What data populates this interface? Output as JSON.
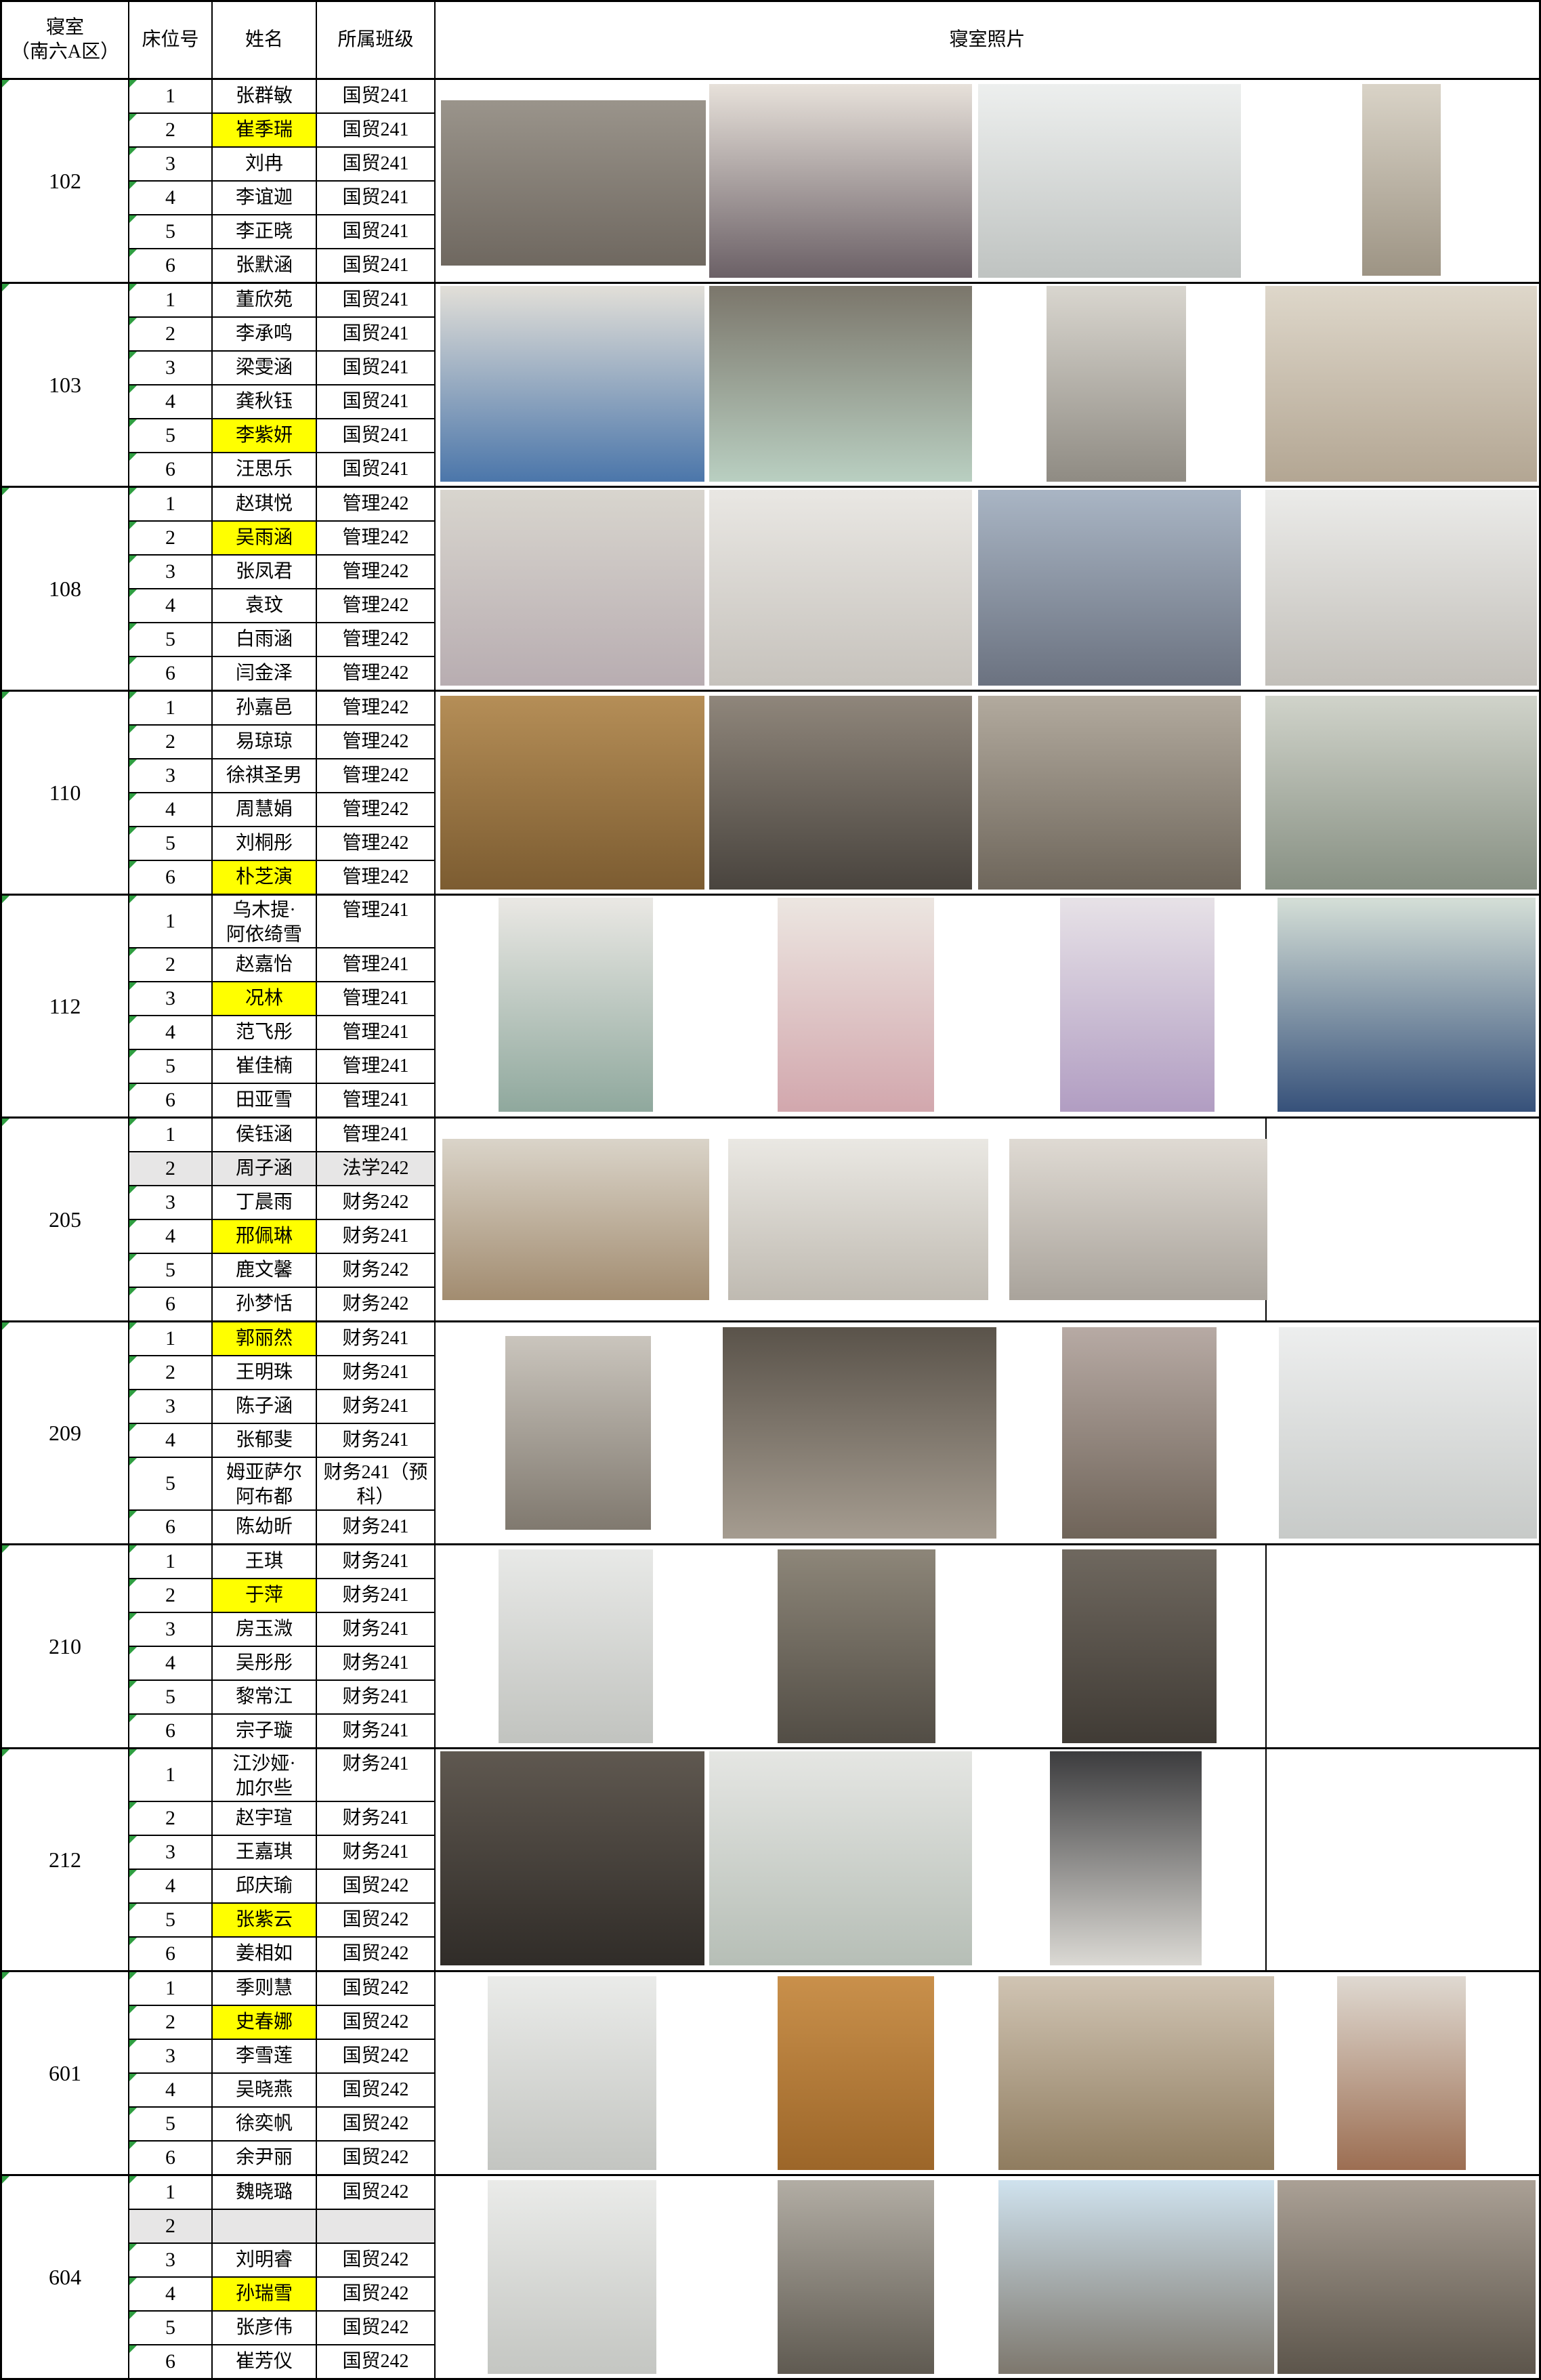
{
  "header": {
    "room": "寝室\n（南六A区）",
    "bed": "床位号",
    "name": "姓名",
    "cls": "所属班级",
    "photos": "寝室照片"
  },
  "colors": {
    "highlight_yellow": "#ffff00",
    "vacant_gray": "#e7e6e6",
    "triangle_green": "#2f9e41",
    "border_black": "#000000"
  },
  "rooms": [
    {
      "id": "102",
      "beds": [
        {
          "no": "1",
          "name": "张群敏",
          "cls": "国贸241"
        },
        {
          "no": "2",
          "name": "崔季瑞",
          "cls": "国贸241",
          "hl": true
        },
        {
          "no": "3",
          "name": "刘冉",
          "cls": "国贸241"
        },
        {
          "no": "4",
          "name": "李谊迦",
          "cls": "国贸241"
        },
        {
          "no": "5",
          "name": "李正晓",
          "cls": "国贸241"
        },
        {
          "no": "6",
          "name": "张默涵",
          "cls": "国贸241"
        }
      ],
      "photos": [
        {
          "desc": "bunk-room-doorway",
          "x": 0.5,
          "w": 24,
          "y": 10,
          "h": 82,
          "c": [
            "#9a948b",
            "#6f6860"
          ]
        },
        {
          "desc": "hanging-clothes",
          "x": 24.8,
          "w": 23.8,
          "y": 2,
          "h": 96,
          "c": [
            "#e7e1da",
            "#6b6066"
          ]
        },
        {
          "desc": "washroom-pipes-sink",
          "x": 49.2,
          "w": 23.8,
          "y": 2,
          "h": 96,
          "c": [
            "#edefee",
            "#bfc3c1"
          ]
        },
        {
          "desc": "tall-storage-cabinet",
          "x": 84,
          "w": 7.1,
          "y": 2,
          "h": 95,
          "c": [
            "#d9d3c7",
            "#9d9484"
          ]
        }
      ]
    },
    {
      "id": "103",
      "beds": [
        {
          "no": "1",
          "name": "董欣苑",
          "cls": "国贸241"
        },
        {
          "no": "2",
          "name": "李承鸣",
          "cls": "国贸241"
        },
        {
          "no": "3",
          "name": "梁雯涵",
          "cls": "国贸241"
        },
        {
          "no": "4",
          "name": "龚秋钰",
          "cls": "国贸241"
        },
        {
          "no": "5",
          "name": "李紫妍",
          "cls": "国贸241",
          "hl": true
        },
        {
          "no": "6",
          "name": "汪思乐",
          "cls": "国贸241"
        }
      ],
      "photos": [
        {
          "desc": "bed-blue-plaid",
          "x": 0.4,
          "w": 24,
          "y": 1,
          "h": 97,
          "c": [
            "#e2dfd8",
            "#4b76aa"
          ]
        },
        {
          "desc": "desk-bookshelf",
          "x": 24.8,
          "w": 23.8,
          "y": 1,
          "h": 97,
          "c": [
            "#7b766b",
            "#b9cfc1"
          ]
        },
        {
          "desc": "corridor-bunks",
          "x": 55.4,
          "w": 12.6,
          "y": 1,
          "h": 97,
          "c": [
            "#d9d6cf",
            "#8f8b83"
          ]
        },
        {
          "desc": "bathroom-squat-toilet",
          "x": 75.2,
          "w": 24.6,
          "y": 1,
          "h": 97,
          "c": [
            "#ded7ca",
            "#b3a693"
          ]
        }
      ]
    },
    {
      "id": "108",
      "beds": [
        {
          "no": "1",
          "name": "赵琪悦",
          "cls": "管理242"
        },
        {
          "no": "2",
          "name": "吴雨涵",
          "cls": "管理242",
          "hl": true
        },
        {
          "no": "3",
          "name": "张凤君",
          "cls": "管理242"
        },
        {
          "no": "4",
          "name": "袁玟",
          "cls": "管理242"
        },
        {
          "no": "5",
          "name": "白雨涵",
          "cls": "管理242"
        },
        {
          "no": "6",
          "name": "闫金泽",
          "cls": "管理242"
        }
      ],
      "photos": [
        {
          "desc": "balcony-window-room",
          "x": 0.4,
          "w": 24,
          "y": 1,
          "h": 97,
          "c": [
            "#d8d5ce",
            "#b8adb1"
          ]
        },
        {
          "desc": "white-lockers",
          "x": 24.8,
          "w": 23.8,
          "y": 1,
          "h": 97,
          "c": [
            "#e9e7e3",
            "#c6c2bc"
          ]
        },
        {
          "desc": "corridor-blue-curtains",
          "x": 49.2,
          "w": 23.8,
          "y": 1,
          "h": 97,
          "c": [
            "#a9b5c4",
            "#6b7280"
          ]
        },
        {
          "desc": "washroom-double-sink",
          "x": 75.2,
          "w": 24.6,
          "y": 1,
          "h": 97,
          "c": [
            "#ebebe9",
            "#c2bfb9"
          ]
        }
      ]
    },
    {
      "id": "110",
      "beds": [
        {
          "no": "1",
          "name": "孙嘉邑",
          "cls": "管理242"
        },
        {
          "no": "2",
          "name": "易琼琼",
          "cls": "管理242"
        },
        {
          "no": "3",
          "name": "徐祺圣男",
          "cls": "管理242"
        },
        {
          "no": "4",
          "name": "周慧娟",
          "cls": "管理242"
        },
        {
          "no": "5",
          "name": "刘桐彤",
          "cls": "管理242"
        },
        {
          "no": "6",
          "name": "朴芝演",
          "cls": "管理242",
          "hl": true
        }
      ],
      "photos": [
        {
          "desc": "poster-drawing-on-desk",
          "x": 0.4,
          "w": 24,
          "y": 2,
          "h": 96,
          "c": [
            "#b58e57",
            "#7c5c31"
          ]
        },
        {
          "desc": "dark-room-corner",
          "x": 24.8,
          "w": 23.8,
          "y": 2,
          "h": 96,
          "c": [
            "#8f867b",
            "#49443e"
          ]
        },
        {
          "desc": "bunks-near-window",
          "x": 49.2,
          "w": 23.8,
          "y": 2,
          "h": 96,
          "c": [
            "#b2aa9e",
            "#6e665b"
          ]
        },
        {
          "desc": "bunks-white-curtain",
          "x": 75.2,
          "w": 24.6,
          "y": 2,
          "h": 96,
          "c": [
            "#d0d3ca",
            "#879083"
          ]
        }
      ]
    },
    {
      "id": "112",
      "beds": [
        {
          "no": "1",
          "name": "乌木提·\n阿依绮雪",
          "cls": "管理241",
          "tall": true
        },
        {
          "no": "2",
          "name": "赵嘉怡",
          "cls": "管理241"
        },
        {
          "no": "3",
          "name": "况林",
          "cls": "管理241",
          "hl": true
        },
        {
          "no": "4",
          "name": "范飞彤",
          "cls": "管理241"
        },
        {
          "no": "5",
          "name": "崔佳楠",
          "cls": "管理241"
        },
        {
          "no": "6",
          "name": "田亚雪",
          "cls": "管理241"
        }
      ],
      "photos": [
        {
          "desc": "shoe-rack",
          "x": 5.7,
          "w": 14,
          "y": 1,
          "h": 97,
          "c": [
            "#eae8e4",
            "#8fa89d"
          ]
        },
        {
          "desc": "pink-bunk-shelves",
          "x": 31,
          "w": 14.2,
          "y": 1,
          "h": 97,
          "c": [
            "#ece6e1",
            "#d2a7ad"
          ]
        },
        {
          "desc": "purple-bunk-shelves",
          "x": 56.6,
          "w": 14,
          "y": 1,
          "h": 97,
          "c": [
            "#e7e2e7",
            "#b19dc2"
          ]
        },
        {
          "desc": "blue-curtained-bunks",
          "x": 76.3,
          "w": 23.4,
          "y": 1,
          "h": 97,
          "c": [
            "#d5dfd7",
            "#36517a"
          ]
        }
      ]
    },
    {
      "id": "205",
      "divider": true,
      "beds": [
        {
          "no": "1",
          "name": "侯钰涵",
          "cls": "管理241"
        },
        {
          "no": "2",
          "name": "周子涵",
          "cls": "法学242",
          "gray": true
        },
        {
          "no": "3",
          "name": "丁晨雨",
          "cls": "财务242"
        },
        {
          "no": "4",
          "name": "邢佩琳",
          "cls": "财务241",
          "hl": true
        },
        {
          "no": "5",
          "name": "鹿文馨",
          "cls": "财务242"
        },
        {
          "no": "6",
          "name": "孙梦恬",
          "cls": "财务242"
        }
      ],
      "photos": [
        {
          "desc": "bunk-room-wood-floor",
          "x": 0.6,
          "w": 24.2,
          "y": 10,
          "h": 80,
          "c": [
            "#dad4c9",
            "#a28c70"
          ]
        },
        {
          "desc": "white-bunk-beds",
          "x": 26.5,
          "w": 23.6,
          "y": 10,
          "h": 80,
          "c": [
            "#eae8e3",
            "#bfbab1"
          ]
        },
        {
          "desc": "desks-shelf-ladder",
          "x": 52,
          "w": 23.4,
          "y": 10,
          "h": 80,
          "c": [
            "#dfdad3",
            "#a9a39b"
          ]
        }
      ]
    },
    {
      "id": "209",
      "beds": [
        {
          "no": "1",
          "name": "郭丽然",
          "cls": "财务241",
          "hl": true
        },
        {
          "no": "2",
          "name": "王明珠",
          "cls": "财务241"
        },
        {
          "no": "3",
          "name": "陈子涵",
          "cls": "财务241"
        },
        {
          "no": "4",
          "name": "张郁斐",
          "cls": "财务241"
        },
        {
          "no": "5",
          "name": "姆亚萨尔\n阿布都",
          "cls": "财务241（预\n科）",
          "tall": true
        },
        {
          "no": "6",
          "name": "陈幼昕",
          "cls": "财务241"
        }
      ],
      "photos": [
        {
          "desc": "door-lockers-corridor",
          "x": 6.3,
          "w": 13.2,
          "y": 6,
          "h": 88,
          "c": [
            "#cac5bd",
            "#80796f"
          ]
        },
        {
          "desc": "dark-bunks-window",
          "x": 26,
          "w": 24.8,
          "y": 2,
          "h": 96,
          "c": [
            "#5a534a",
            "#a59c90"
          ]
        },
        {
          "desc": "corridor-pink-desks",
          "x": 56.8,
          "w": 14,
          "y": 2,
          "h": 96,
          "c": [
            "#b7aaa4",
            "#6f6459"
          ]
        },
        {
          "desc": "washroom-mirror-sink",
          "x": 76.4,
          "w": 23.4,
          "y": 2,
          "h": 96,
          "c": [
            "#edeeee",
            "#c7cac8"
          ]
        }
      ]
    },
    {
      "id": "210",
      "divider": true,
      "beds": [
        {
          "no": "1",
          "name": "王琪",
          "cls": "财务241"
        },
        {
          "no": "2",
          "name": "于萍",
          "cls": "财务241",
          "hl": true
        },
        {
          "no": "3",
          "name": "房玉溦",
          "cls": "财务241"
        },
        {
          "no": "4",
          "name": "吴彤彤",
          "cls": "财务241"
        },
        {
          "no": "5",
          "name": "黎常江",
          "cls": "财务241"
        },
        {
          "no": "6",
          "name": "宗子璇",
          "cls": "财务241"
        }
      ],
      "photos": [
        {
          "desc": "squat-toilet-room",
          "x": 5.7,
          "w": 14,
          "y": 2,
          "h": 96,
          "c": [
            "#e8e9e7",
            "#c1c3bf"
          ]
        },
        {
          "desc": "corridor-between-lockers",
          "x": 31,
          "w": 14.3,
          "y": 2,
          "h": 96,
          "c": [
            "#8d8679",
            "#524d45"
          ]
        },
        {
          "desc": "dark-corridor-bunks",
          "x": 56.8,
          "w": 14,
          "y": 2,
          "h": 96,
          "c": [
            "#6f685f",
            "#403b35"
          ]
        }
      ]
    },
    {
      "id": "212",
      "divider": true,
      "beds": [
        {
          "no": "1",
          "name": "江沙娅·\n加尔些",
          "cls": "财务241",
          "tall": true
        },
        {
          "no": "2",
          "name": "赵宇瑄",
          "cls": "财务241"
        },
        {
          "no": "3",
          "name": "王嘉琪",
          "cls": "财务241"
        },
        {
          "no": "4",
          "name": "邱庆瑜",
          "cls": "国贸242"
        },
        {
          "no": "5",
          "name": "张紫云",
          "cls": "国贸242",
          "hl": true
        },
        {
          "no": "6",
          "name": "姜相如",
          "cls": "国贸242"
        }
      ],
      "photos": [
        {
          "desc": "dark-bunk-room-door-light",
          "x": 0.4,
          "w": 24,
          "y": 1,
          "h": 97,
          "c": [
            "#5f5850",
            "#302c28"
          ]
        },
        {
          "desc": "washroom-green-basin",
          "x": 24.8,
          "w": 23.8,
          "y": 1,
          "h": 97,
          "c": [
            "#e5e6e3",
            "#b6beb6"
          ]
        },
        {
          "desc": "white-corridor-clothes-top",
          "x": 55.7,
          "w": 13.7,
          "y": 1,
          "h": 97,
          "c": [
            "#3c3c3e",
            "#dbd9d4"
          ]
        }
      ]
    },
    {
      "id": "601",
      "beds": [
        {
          "no": "1",
          "name": "季则慧",
          "cls": "国贸242"
        },
        {
          "no": "2",
          "name": "史春娜",
          "cls": "国贸242",
          "hl": true
        },
        {
          "no": "3",
          "name": "李雪莲",
          "cls": "国贸242"
        },
        {
          "no": "4",
          "name": "吴晓燕",
          "cls": "国贸242"
        },
        {
          "no": "5",
          "name": "徐奕帆",
          "cls": "国贸242"
        },
        {
          "no": "6",
          "name": "余尹丽",
          "cls": "国贸242"
        }
      ],
      "photos": [
        {
          "desc": "bathroom-tall",
          "x": 4.7,
          "w": 15.3,
          "y": 2,
          "h": 96,
          "c": [
            "#eaebe9",
            "#c3c5c1"
          ]
        },
        {
          "desc": "wooden-door-red-sign",
          "x": 31,
          "w": 14.2,
          "y": 2,
          "h": 96,
          "c": [
            "#c9904b",
            "#9c6629"
          ]
        },
        {
          "desc": "desks-bookshelves-ladder",
          "x": 51,
          "w": 25,
          "y": 2,
          "h": 96,
          "c": [
            "#d0c4b3",
            "#8f7c5f"
          ]
        },
        {
          "desc": "bunk-room-red-floor",
          "x": 81.7,
          "w": 11.7,
          "y": 2,
          "h": 96,
          "c": [
            "#dfd9d1",
            "#9c6e52"
          ]
        }
      ]
    },
    {
      "id": "604",
      "beds": [
        {
          "no": "1",
          "name": "魏晓璐",
          "cls": "国贸242"
        },
        {
          "no": "2",
          "name": "",
          "cls": "",
          "gray": true
        },
        {
          "no": "3",
          "name": "刘明睿",
          "cls": "国贸242"
        },
        {
          "no": "4",
          "name": "孙瑞雪",
          "cls": "国贸242",
          "hl": true
        },
        {
          "no": "5",
          "name": "张彦伟",
          "cls": "国贸242"
        },
        {
          "no": "6",
          "name": "崔芳仪",
          "cls": "国贸242"
        }
      ],
      "photos": [
        {
          "desc": "bathroom-sink-toilet",
          "x": 4.7,
          "w": 15.3,
          "y": 2,
          "h": 96,
          "c": [
            "#eaebe9",
            "#c4c6c2"
          ]
        },
        {
          "desc": "lockers-dark-corridor",
          "x": 31,
          "w": 14.2,
          "y": 2,
          "h": 96,
          "c": [
            "#b2ada4",
            "#5f5a51"
          ]
        },
        {
          "desc": "window-city-view",
          "x": 51,
          "w": 25,
          "y": 2,
          "h": 96,
          "c": [
            "#cfe2ee",
            "#7d776d"
          ]
        },
        {
          "desc": "clothes-rack-corridor",
          "x": 76.3,
          "w": 23.4,
          "y": 2,
          "h": 96,
          "c": [
            "#aaa095",
            "#5c554b"
          ]
        }
      ]
    }
  ]
}
